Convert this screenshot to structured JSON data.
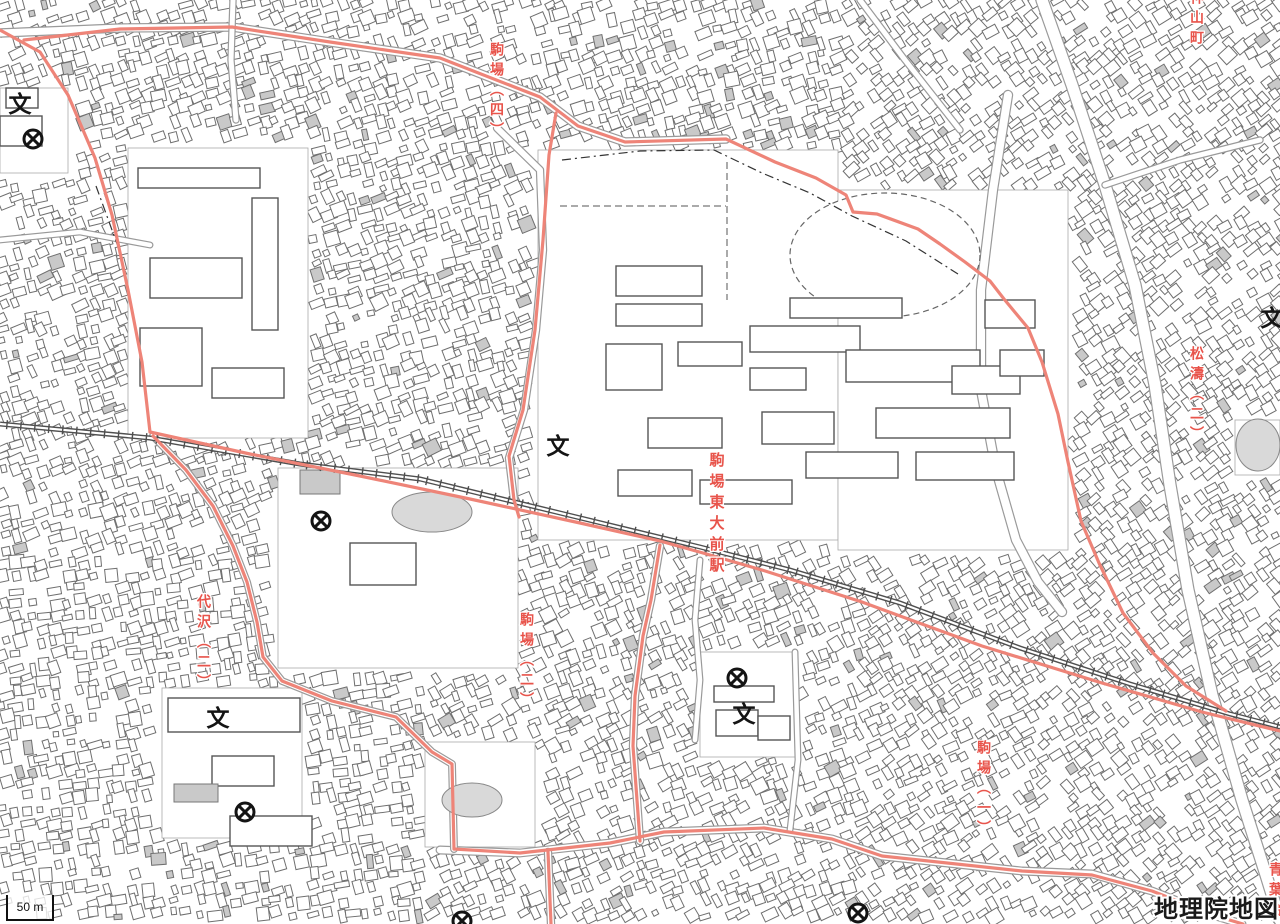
{
  "map": {
    "attribution": "地理院地図",
    "scale_label": "50 m",
    "colors": {
      "boundary": "#ee8478",
      "label_red": "#e8544b",
      "building_stroke": "#6f6f6f",
      "gray_fill": "#c9c9c9",
      "railway": "#4f4f4f",
      "road_casing": "#9a9a9a",
      "icon_black": "#141414",
      "pond_fill": "#d9d9d9"
    },
    "place_labels": [
      {
        "id": "komaba-4",
        "text": "駒場（四）",
        "x": 497,
        "y": 42,
        "size": 14
      },
      {
        "id": "kamiyamacho",
        "text": "神山町",
        "x": 1197,
        "y": -10,
        "size": 14
      },
      {
        "id": "shoto-2",
        "text": "松濤（二）",
        "x": 1197,
        "y": 346,
        "size": 14
      },
      {
        "id": "komaba-todaimae-station",
        "text": "駒場東大前駅",
        "x": 716,
        "y": 452,
        "size": 15
      },
      {
        "id": "daizawa-2",
        "text": "代沢（二）",
        "x": 204,
        "y": 594,
        "size": 14
      },
      {
        "id": "komaba-2",
        "text": "駒場（二）",
        "x": 527,
        "y": 612,
        "size": 14
      },
      {
        "id": "komaba-1",
        "text": "駒場（一）",
        "x": 984,
        "y": 740,
        "size": 14
      },
      {
        "id": "aobadai-partial",
        "text": "青葉台",
        "x": 1276,
        "y": 862,
        "size": 14
      }
    ],
    "icons": [
      {
        "type": "school",
        "x": 20,
        "y": 104
      },
      {
        "type": "school",
        "x": 558,
        "y": 446
      },
      {
        "type": "school",
        "x": 1272,
        "y": 318
      },
      {
        "type": "school",
        "x": 218,
        "y": 718
      },
      {
        "type": "school",
        "x": 744,
        "y": 714
      },
      {
        "type": "police",
        "x": 33,
        "y": 139
      },
      {
        "type": "police",
        "x": 321,
        "y": 521
      },
      {
        "type": "police",
        "x": 737,
        "y": 678
      },
      {
        "type": "police",
        "x": 245,
        "y": 812
      },
      {
        "type": "police",
        "x": 858,
        "y": 913
      },
      {
        "type": "police",
        "x": 462,
        "y": 921
      }
    ],
    "railway": [
      [
        0,
        424
      ],
      [
        150,
        438
      ],
      [
        300,
        464
      ],
      [
        420,
        479
      ],
      [
        560,
        513
      ],
      [
        700,
        547
      ],
      [
        790,
        570
      ],
      [
        900,
        603
      ],
      [
        1020,
        648
      ],
      [
        1130,
        684
      ],
      [
        1230,
        714
      ],
      [
        1280,
        727
      ]
    ],
    "boundaries": [
      [
        [
          0,
          30
        ],
        [
          40,
          52
        ],
        [
          68,
          95
        ],
        [
          95,
          158
        ],
        [
          112,
          215
        ],
        [
          128,
          290
        ],
        [
          142,
          362
        ],
        [
          150,
          432
        ]
      ],
      [
        [
          150,
          432
        ],
        [
          250,
          454
        ],
        [
          360,
          476
        ],
        [
          470,
          499
        ],
        [
          580,
          523
        ],
        [
          660,
          541
        ],
        [
          703,
          553
        ],
        [
          762,
          570
        ],
        [
          862,
          602
        ],
        [
          982,
          646
        ],
        [
          1102,
          683
        ],
        [
          1202,
          712
        ],
        [
          1280,
          731
        ]
      ],
      [
        [
          24,
          40
        ],
        [
          120,
          29
        ],
        [
          232,
          27
        ],
        [
          330,
          42
        ],
        [
          440,
          58
        ],
        [
          540,
          97
        ],
        [
          578,
          126
        ],
        [
          625,
          142
        ],
        [
          726,
          139
        ],
        [
          775,
          162
        ],
        [
          816,
          178
        ],
        [
          846,
          195
        ],
        [
          853,
          212
        ],
        [
          877,
          214
        ],
        [
          918,
          229
        ],
        [
          940,
          244
        ],
        [
          965,
          262
        ],
        [
          990,
          281
        ],
        [
          1004,
          299
        ],
        [
          1028,
          328
        ],
        [
          1042,
          362
        ],
        [
          1058,
          414
        ],
        [
          1068,
          462
        ],
        [
          1081,
          521
        ],
        [
          1099,
          563
        ],
        [
          1123,
          613
        ],
        [
          1153,
          653
        ],
        [
          1186,
          686
        ],
        [
          1226,
          711
        ]
      ],
      [
        [
          556,
          113
        ],
        [
          549,
          155
        ],
        [
          543,
          240
        ],
        [
          535,
          330
        ],
        [
          523,
          410
        ],
        [
          509,
          456
        ],
        [
          514,
          500
        ],
        [
          519,
          517
        ]
      ],
      [
        [
          153,
          436
        ],
        [
          186,
          470
        ],
        [
          213,
          506
        ],
        [
          233,
          546
        ],
        [
          247,
          582
        ],
        [
          257,
          622
        ],
        [
          263,
          657
        ],
        [
          282,
          681
        ],
        [
          332,
          701
        ],
        [
          396,
          717
        ],
        [
          432,
          752
        ],
        [
          452,
          764
        ],
        [
          454,
          849
        ]
      ],
      [
        [
          454,
          849
        ],
        [
          520,
          853
        ],
        [
          610,
          843
        ],
        [
          664,
          832
        ],
        [
          764,
          828
        ],
        [
          832,
          839
        ],
        [
          882,
          856
        ],
        [
          1022,
          871
        ],
        [
          1092,
          875
        ],
        [
          1152,
          891
        ],
        [
          1216,
          916
        ],
        [
          1243,
          924
        ]
      ],
      [
        [
          660,
          545
        ],
        [
          651,
          600
        ],
        [
          643,
          636
        ],
        [
          635,
          696
        ],
        [
          633,
          746
        ],
        [
          637,
          800
        ],
        [
          640,
          841
        ]
      ],
      [
        [
          548,
          852
        ],
        [
          551,
          924
        ]
      ]
    ],
    "roads": [
      {
        "pts": [
          [
            0,
            33
          ],
          [
            120,
            28
          ],
          [
            232,
            27
          ],
          [
            330,
            42
          ],
          [
            440,
            58
          ],
          [
            540,
            97
          ],
          [
            578,
            126
          ],
          [
            625,
            142
          ],
          [
            726,
            139
          ]
        ],
        "w": 7
      },
      {
        "pts": [
          [
            1042,
            0
          ],
          [
            1072,
            85
          ],
          [
            1105,
            185
          ],
          [
            1135,
            285
          ],
          [
            1155,
            385
          ],
          [
            1170,
            485
          ],
          [
            1188,
            590
          ],
          [
            1212,
            695
          ],
          [
            1242,
            800
          ],
          [
            1266,
            875
          ],
          [
            1280,
            920
          ]
        ],
        "w": 11
      },
      {
        "pts": [
          [
            1008,
            95
          ],
          [
            993,
            190
          ],
          [
            981,
            290
          ],
          [
            981,
            390
          ],
          [
            996,
            470
          ],
          [
            1016,
            540
          ],
          [
            1038,
            582
          ],
          [
            1062,
            612
          ]
        ],
        "w": 8
      },
      {
        "pts": [
          [
            497,
            128
          ],
          [
            540,
            170
          ],
          [
            543,
            250
          ],
          [
            536,
            330
          ],
          [
            524,
            410
          ],
          [
            509,
            458
          ],
          [
            514,
            500
          ]
        ],
        "w": 6
      },
      {
        "pts": [
          [
            440,
            850
          ],
          [
            520,
            853
          ],
          [
            610,
            843
          ],
          [
            664,
            832
          ],
          [
            764,
            828
          ],
          [
            832,
            839
          ],
          [
            882,
            856
          ],
          [
            1022,
            871
          ],
          [
            1092,
            874
          ],
          [
            1152,
            891
          ],
          [
            1216,
            916
          ],
          [
            1242,
            924
          ]
        ],
        "w": 6.5
      },
      {
        "pts": [
          [
            660,
            546
          ],
          [
            651,
            600
          ],
          [
            643,
            636
          ],
          [
            635,
            696
          ],
          [
            633,
            746
          ],
          [
            637,
            800
          ],
          [
            640,
            841
          ]
        ],
        "w": 6
      },
      {
        "pts": [
          [
            548,
            852
          ],
          [
            551,
            924
          ]
        ],
        "w": 6
      },
      {
        "pts": [
          [
            153,
            436
          ],
          [
            186,
            470
          ],
          [
            213,
            506
          ],
          [
            233,
            546
          ],
          [
            247,
            582
          ],
          [
            257,
            622
          ],
          [
            263,
            657
          ],
          [
            282,
            681
          ],
          [
            332,
            701
          ],
          [
            396,
            717
          ],
          [
            432,
            752
          ],
          [
            452,
            764
          ],
          [
            454,
            849
          ]
        ],
        "w": 5.5
      },
      {
        "pts": [
          [
            233,
            0
          ],
          [
            231,
            60
          ],
          [
            236,
            120
          ]
        ],
        "w": 5
      },
      {
        "pts": [
          [
            860,
            0
          ],
          [
            905,
            60
          ],
          [
            960,
            130
          ]
        ],
        "w": 5
      },
      {
        "pts": [
          [
            1105,
            185
          ],
          [
            1180,
            160
          ],
          [
            1260,
            140
          ]
        ],
        "w": 5
      },
      {
        "pts": [
          [
            795,
            652
          ],
          [
            798,
            760
          ],
          [
            790,
            830
          ]
        ],
        "w": 4.5
      },
      {
        "pts": [
          [
            700,
            560
          ],
          [
            695,
            620
          ],
          [
            700,
            680
          ],
          [
            695,
            740
          ]
        ],
        "w": 4.5
      },
      {
        "pts": [
          [
            0,
            240
          ],
          [
            80,
            232
          ],
          [
            150,
            245
          ]
        ],
        "w": 4.5
      }
    ],
    "dashdot": [
      [
        [
          562,
          160
        ],
        [
          640,
          151
        ],
        [
          714,
          150
        ],
        [
          762,
          173
        ],
        [
          810,
          193
        ],
        [
          852,
          216
        ],
        [
          906,
          241
        ],
        [
          958,
          274
        ]
      ],
      [
        [
          96,
          186
        ],
        [
          120,
          252
        ],
        [
          134,
          318
        ]
      ]
    ],
    "dashed": [
      [
        [
          727,
          162
        ],
        [
          727,
          300
        ]
      ],
      [
        [
          560,
          206
        ],
        [
          726,
          206
        ]
      ]
    ],
    "open_areas": [
      [
        538,
        150,
        300,
        390
      ],
      [
        838,
        190,
        230,
        360
      ],
      [
        128,
        148,
        180,
        290
      ],
      [
        278,
        468,
        240,
        200
      ],
      [
        425,
        742,
        110,
        105
      ],
      [
        162,
        688,
        140,
        150
      ],
      [
        700,
        652,
        95,
        105
      ],
      [
        0,
        88,
        68,
        85
      ],
      [
        1235,
        420,
        45,
        55
      ]
    ],
    "buildings": [
      [
        616,
        266,
        86,
        30
      ],
      [
        616,
        304,
        86,
        22
      ],
      [
        606,
        344,
        56,
        46
      ],
      [
        678,
        342,
        64,
        24
      ],
      [
        750,
        326,
        110,
        26
      ],
      [
        750,
        368,
        56,
        22
      ],
      [
        790,
        298,
        112,
        20
      ],
      [
        846,
        350,
        134,
        32
      ],
      [
        762,
        412,
        72,
        32
      ],
      [
        648,
        418,
        74,
        30
      ],
      [
        876,
        408,
        134,
        30
      ],
      [
        952,
        366,
        68,
        28
      ],
      [
        806,
        452,
        92,
        26
      ],
      [
        916,
        452,
        98,
        28
      ],
      [
        618,
        470,
        74,
        26
      ],
      [
        700,
        480,
        92,
        24
      ],
      [
        985,
        300,
        50,
        28
      ],
      [
        1000,
        350,
        44,
        26
      ],
      [
        138,
        168,
        122,
        20
      ],
      [
        252,
        198,
        26,
        132
      ],
      [
        150,
        258,
        92,
        40
      ],
      [
        140,
        328,
        62,
        58
      ],
      [
        212,
        368,
        72,
        30
      ],
      [
        168,
        698,
        132,
        34
      ],
      [
        212,
        756,
        62,
        30
      ],
      [
        230,
        816,
        82,
        30
      ],
      [
        714,
        686,
        60,
        16
      ],
      [
        716,
        710,
        42,
        26
      ],
      [
        758,
        716,
        32,
        24
      ],
      [
        350,
        543,
        66,
        42
      ],
      [
        0,
        116,
        42,
        30
      ],
      [
        6,
        88,
        32,
        20
      ]
    ],
    "gray_buildings": [
      [
        174,
        784,
        44,
        18
      ],
      [
        300,
        470,
        40,
        24
      ]
    ],
    "ovals": [
      {
        "cx": 885,
        "cy": 255,
        "rx": 80,
        "ry": 50,
        "dash": false
      },
      {
        "cx": 885,
        "cy": 255,
        "rx": 95,
        "ry": 62,
        "dash": true
      }
    ],
    "ponds": [
      {
        "cx": 432,
        "cy": 512,
        "rx": 40,
        "ry": 20
      },
      {
        "cx": 472,
        "cy": 800,
        "rx": 30,
        "ry": 17
      },
      {
        "cx": 1258,
        "cy": 445,
        "rx": 22,
        "ry": 26
      }
    ]
  }
}
